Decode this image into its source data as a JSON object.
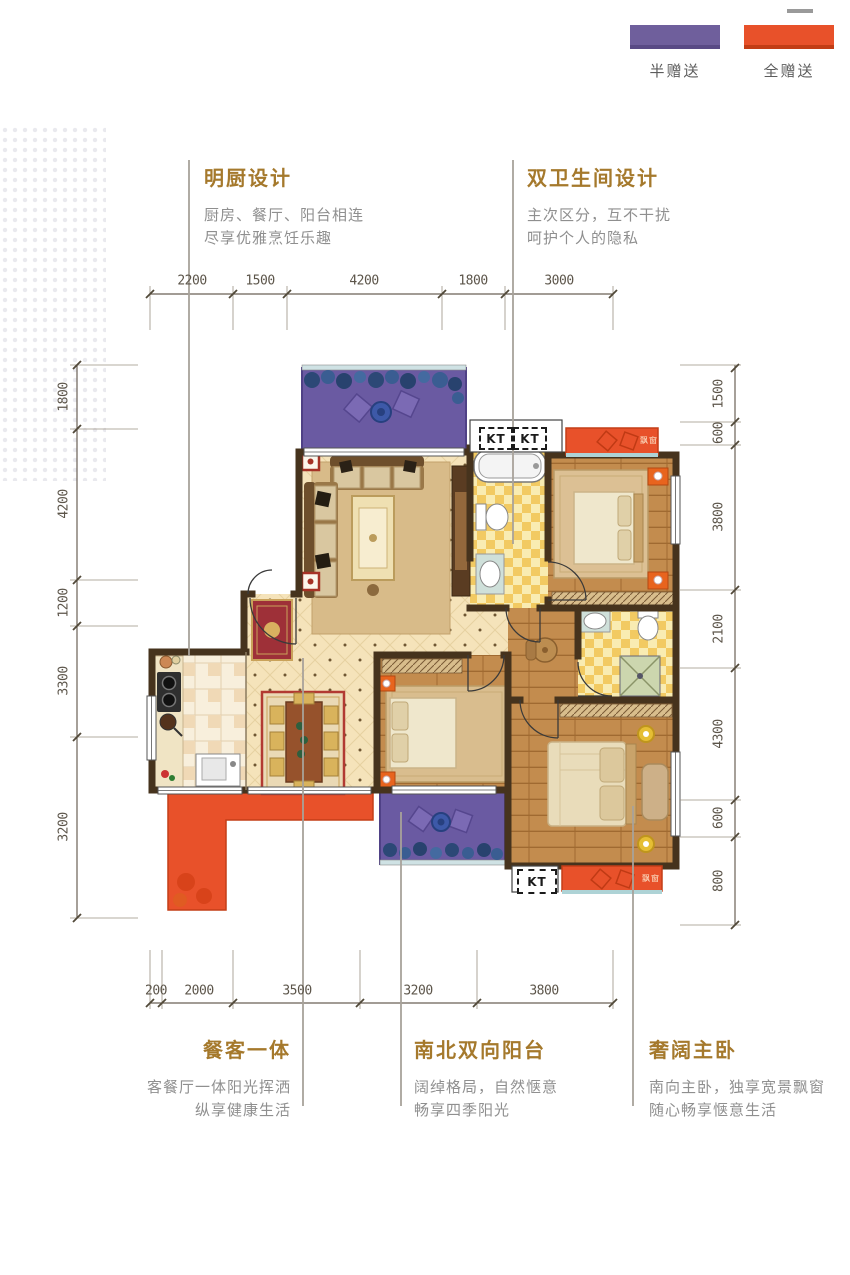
{
  "legend": {
    "items": [
      {
        "label": "半赠送",
        "color": "#6f5f9c"
      },
      {
        "label": "全赠送",
        "color": "#e8512a"
      }
    ]
  },
  "features": {
    "top_left": {
      "title": "明厨设计",
      "line1": "厨房、餐厅、阳台相连",
      "line2": "尽享优雅烹饪乐趣"
    },
    "top_right": {
      "title": "双卫生间设计",
      "line1": "主次区分，互不干扰",
      "line2": "呵护个人的隐私"
    },
    "bottom_left": {
      "title": "餐客一体",
      "line1": "客餐厅一体阳光挥洒",
      "line2": "纵享健康生活"
    },
    "bottom_middle": {
      "title": "南北双向阳台",
      "line1": "阔绰格局，自然惬意",
      "line2": "畅享四季阳光"
    },
    "bottom_right": {
      "title": "奢阔主卧",
      "line1": "南向主卧，独享宽景飘窗",
      "line2": "随心畅享惬意生活"
    }
  },
  "dimensions": {
    "top": [
      "2200",
      "1500",
      "4200",
      "1800",
      "3000"
    ],
    "bottom": [
      "200",
      "2000",
      "3500",
      "3200",
      "3800"
    ],
    "left": [
      "1800",
      "4200",
      "1200",
      "3300",
      "3200"
    ],
    "right": [
      "1500",
      "600",
      "3800",
      "2100",
      "4300",
      "600",
      "800"
    ]
  },
  "plan": {
    "kt_labels": [
      "KT",
      "KT",
      "KT"
    ],
    "bay_window_label": "飘窗",
    "colors": {
      "half_gift": "#6f5f9c",
      "full_gift": "#e8512a",
      "wall": "#46331d",
      "title_gold": "#a5792c",
      "floor_beige": "#f5e3ba",
      "wood": "#c38c4e",
      "bath_tile": "#f2ca62"
    }
  }
}
